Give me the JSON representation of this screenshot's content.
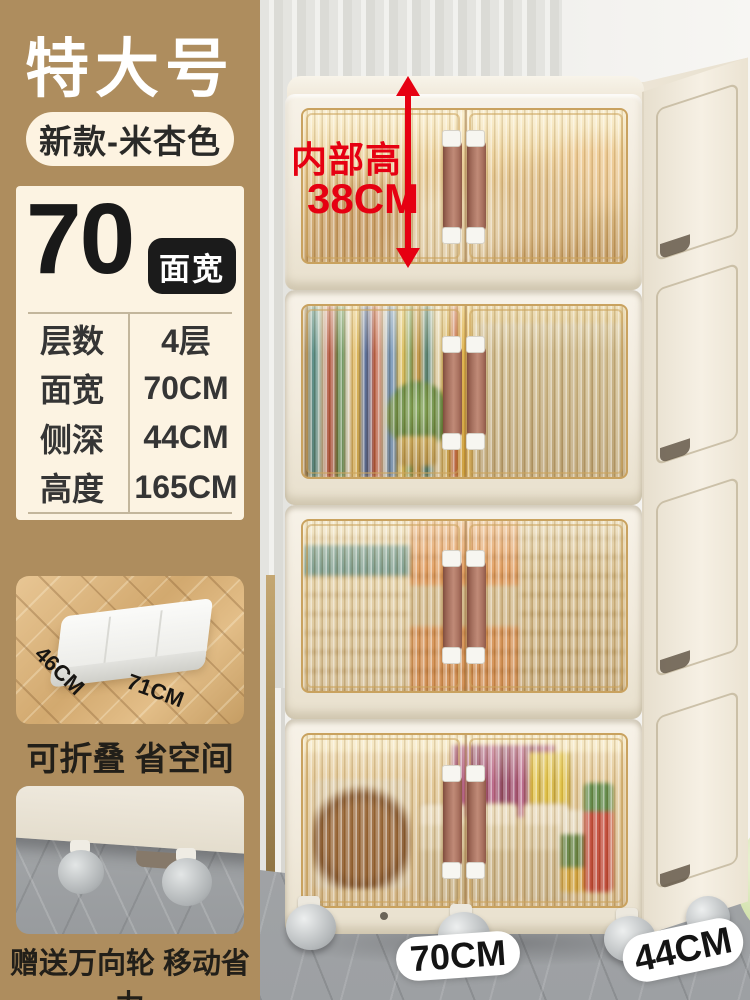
{
  "size_badge": {
    "title": "特大号",
    "variant": "新款-米杏色"
  },
  "spec": {
    "width_number": "70",
    "width_unit_badge": "面宽",
    "rows": [
      {
        "label": "层数",
        "value": "4层"
      },
      {
        "label": "面宽",
        "value": "70CM"
      },
      {
        "label": "侧深",
        "value": "44CM"
      },
      {
        "label": "高度",
        "value": "165CM"
      }
    ]
  },
  "fold_photo": {
    "depth_label": "46CM",
    "width_label": "71CM",
    "caption": "可折叠 省空间"
  },
  "wheel_photo": {
    "caption": "赠送万向轮 移动省力"
  },
  "cabinet_annotation": {
    "line1": "内部高",
    "line2": "38CM"
  },
  "floor_labels": {
    "front_width": "70CM",
    "side_depth": "44CM"
  },
  "icons": {
    "height_measure_arrow": "double-headed-vertical-arrow"
  },
  "colors": {
    "tan_bg": "#ae8d5e",
    "cream_panel": "#fcf3e2",
    "badge_black": "#1b1b1b",
    "accent_red": "#e60012",
    "cabinet_cream": "#f3ece0",
    "door_amber": "#d9b878",
    "handle_brown": "#aa7261",
    "floor_gray": "#a2a4a6"
  }
}
